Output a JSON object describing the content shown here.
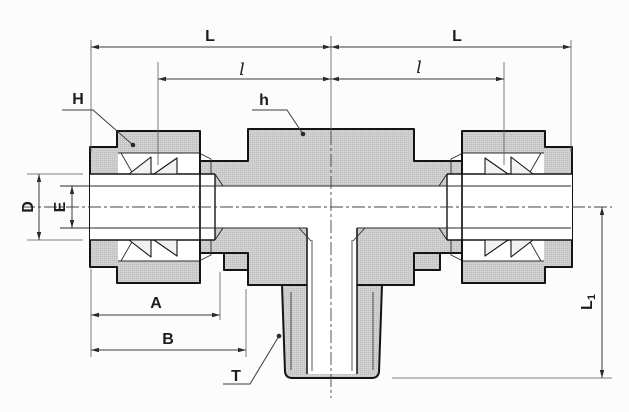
{
  "drawing": {
    "kind": "cross-section engineering drawing",
    "subject": "compression-fitting male branch tee"
  },
  "dimension_labels": {
    "overall_length_left": "L",
    "overall_length_right": "L",
    "sub_length_left": "l",
    "sub_length_right": "l",
    "nut_hex": "H",
    "body_hex": "h",
    "tube_od": "D",
    "bore": "E",
    "depth_a": "A",
    "depth_b": "B",
    "thread": "T",
    "branch_length_base": "L",
    "branch_length_subscript": "1"
  },
  "colors": {
    "background": "#fcfcfc",
    "metal_fill": "#d9d9d9",
    "hatch_line": "#c3c3c3",
    "outline": "#141414",
    "dimension_line": "#3d3d3d"
  }
}
